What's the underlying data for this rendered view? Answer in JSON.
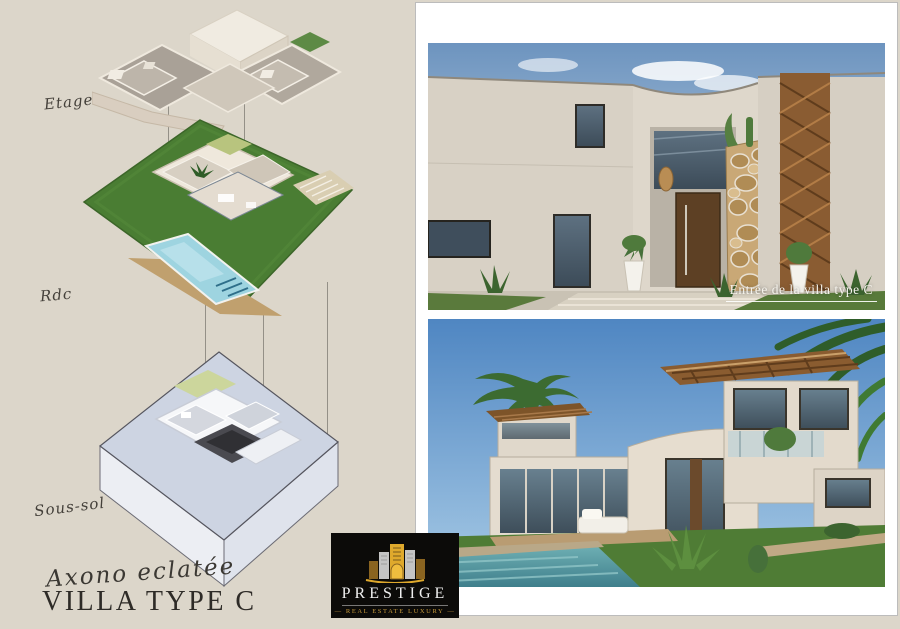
{
  "page": {
    "script_subtitle": "Axono eclatée",
    "main_title": "VILLA TYPE C",
    "background_color": "#dcd6ca"
  },
  "axono": {
    "levels": [
      {
        "label": "Etage"
      },
      {
        "label": "Rdc"
      },
      {
        "label": "Sous-sol"
      }
    ]
  },
  "photos": {
    "entrance_caption": "Entrée de la villa type C"
  },
  "logo": {
    "brand": "PRESTIGE",
    "tagline": "—  REAL ESTATE LUXURY  —",
    "gold": "#d9a525",
    "background": "#0c0b09"
  },
  "colors": {
    "lawn_green": "#4a7d33",
    "pool_blue": "#9ed4e0",
    "basement_slab": "#cdd4e2",
    "facade_beige": "#d8d1c5"
  }
}
